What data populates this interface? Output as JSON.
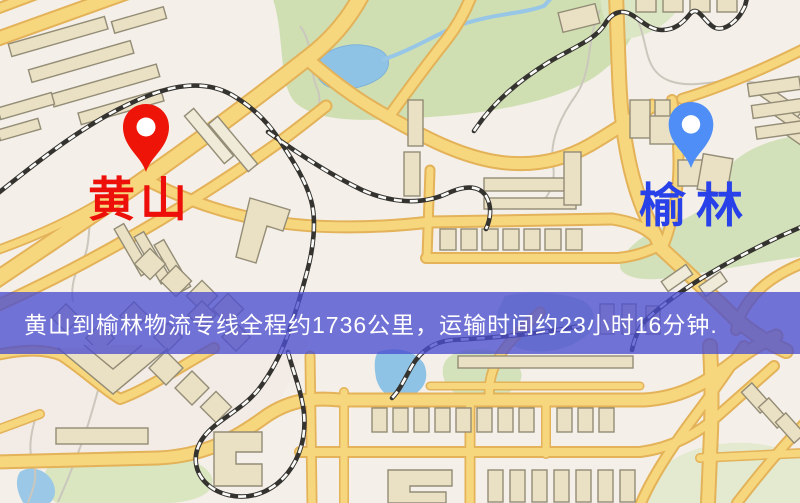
{
  "map": {
    "origin_marker": {
      "label": "黄山",
      "icon": "map-pin-icon",
      "pin_color": "#ee1407",
      "label_color": "#ed100a"
    },
    "destination_marker": {
      "label": "榆林",
      "icon": "map-pin-icon",
      "pin_color": "#4e8ef6",
      "label_color": "#2941e9"
    },
    "banner": {
      "text": "黄山到榆林物流专线全程约1736公里，运输时间约23小时16分钟.",
      "background_color": "#4c4ed0",
      "text_color": "#ffffff",
      "distance_km": "1736",
      "duration": "23小时16分钟"
    },
    "palette": {
      "background": "#f4efe8",
      "road_fill": "#f7d77d",
      "road_casing": "#e3b259",
      "building_fill": "#eae0c4",
      "building_stroke": "#938c76",
      "park_green": "#cfdfb2",
      "water_blue": "#8fc3e6",
      "railway_dark": "#35332f"
    }
  }
}
